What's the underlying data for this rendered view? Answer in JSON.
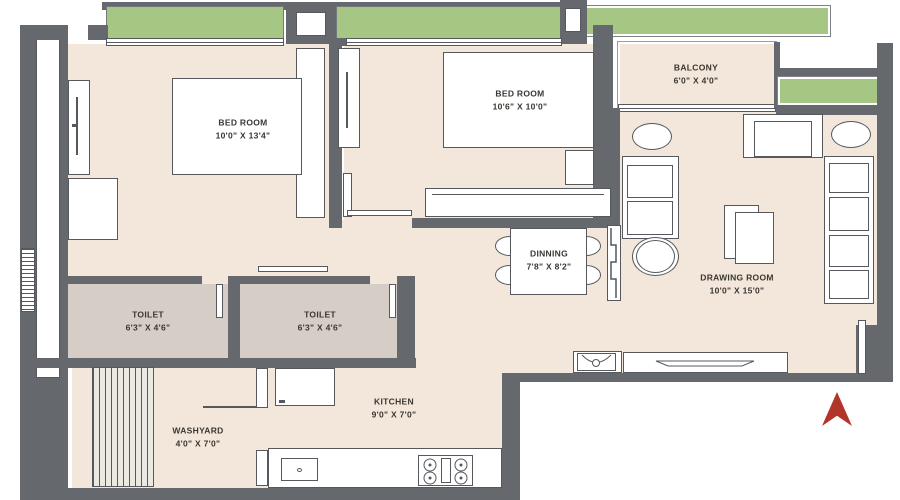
{
  "plan_title": "2BHK Apartment Floor Plan",
  "colors": {
    "wall": "#65686d",
    "room_floor": "#f2e7da",
    "toilet_floor": "#d6cec6",
    "planter_green": "#a6c783",
    "north_arrow": "#b13528",
    "furniture_outline": "#55585c",
    "label_text": "#3a3632"
  },
  "rooms": {
    "bedroom1": {
      "name": "BED ROOM",
      "dims": "10'0\" X 13'4\""
    },
    "bedroom2": {
      "name": "BED ROOM",
      "dims": "10'6\" X 10'0\""
    },
    "balcony": {
      "name": "BALCONY",
      "dims": "6'0\" X 4'0\""
    },
    "drawing": {
      "name": "DRAWING ROOM",
      "dims": "10'0\" X 15'0\""
    },
    "dining": {
      "name": "DINNING",
      "dims": "7'8\" X 8'2\""
    },
    "toilet1": {
      "name": "TOILET",
      "dims": "6'3\" X 4'6\""
    },
    "toilet2": {
      "name": "TOILET",
      "dims": "6'3\" X 4'6\""
    },
    "kitchen": {
      "name": "KITCHEN",
      "dims": "9'0\" X 7'0\""
    },
    "washyard": {
      "name": "WASHYARD",
      "dims": "4'0\" X 7'0\""
    }
  }
}
